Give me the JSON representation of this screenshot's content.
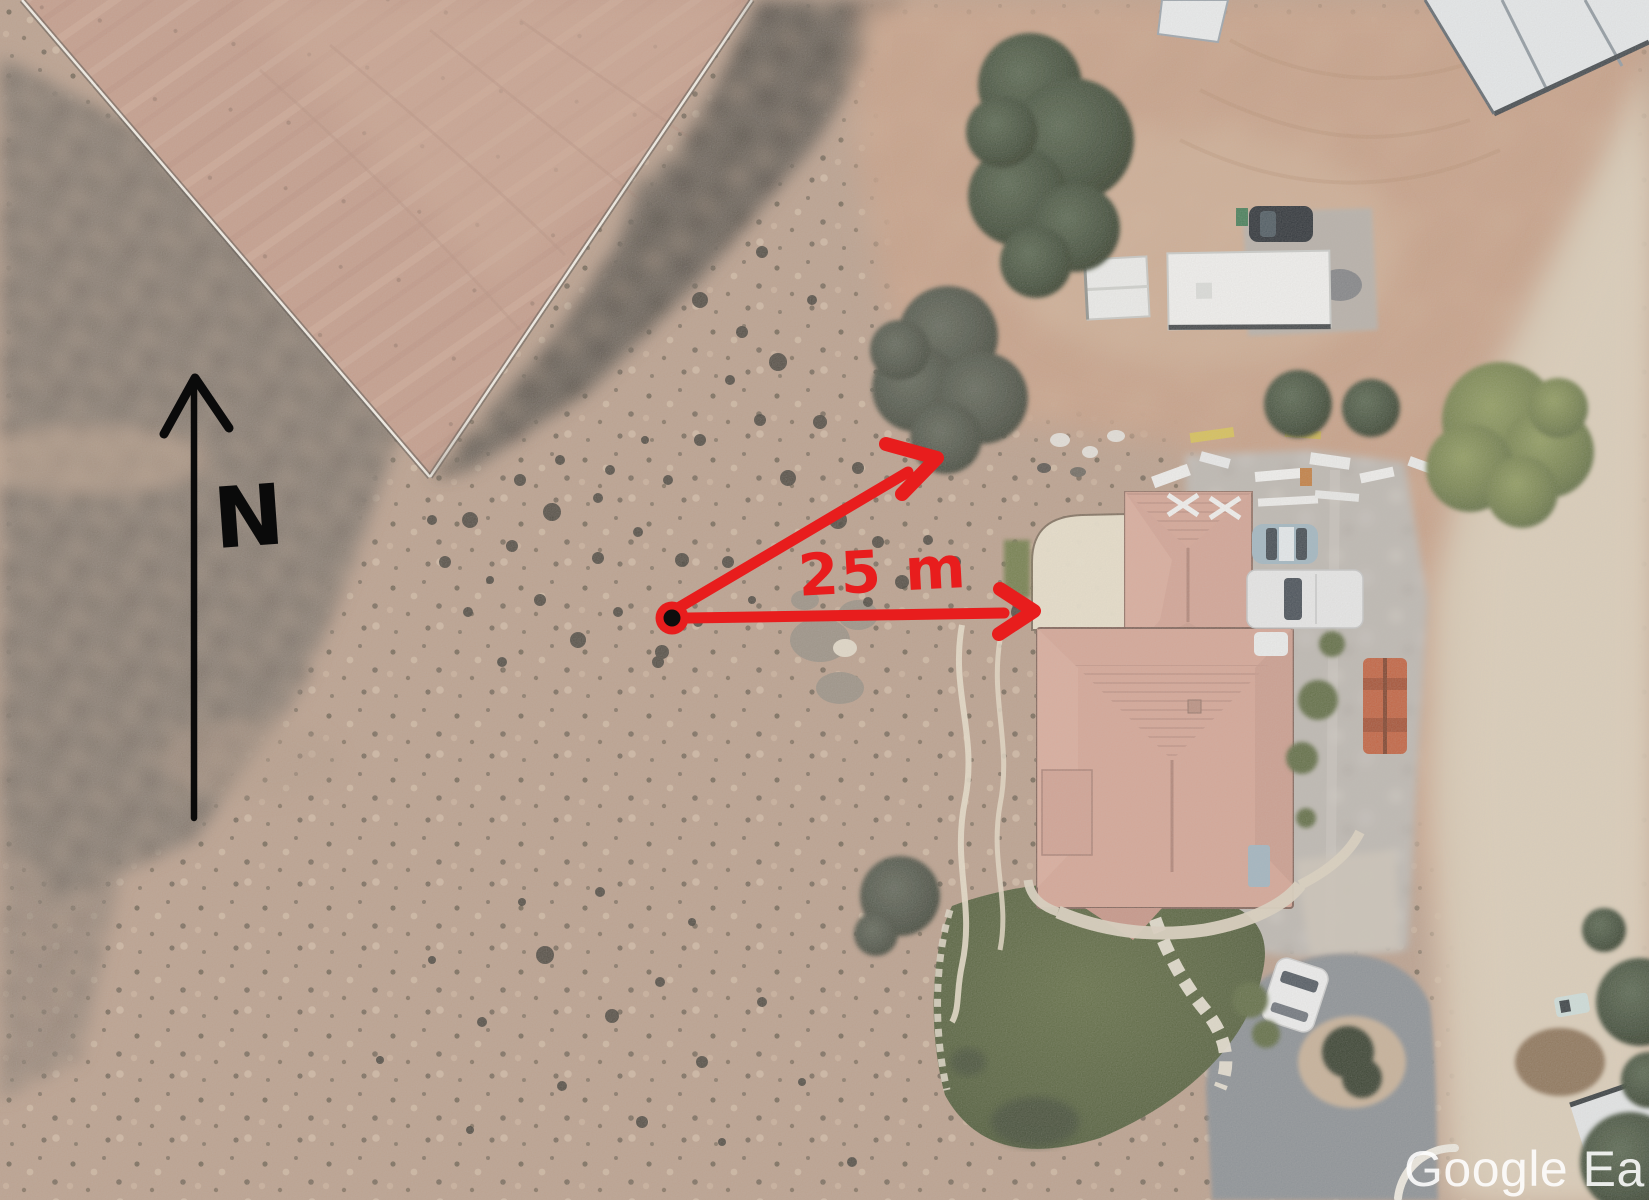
{
  "view": {
    "description": "Aerial satellite photo of a desert property with a house, outbuildings, a graded dirt field, annotated with a north arrow and a 25 m measurement arrow pair",
    "width_px": 1649,
    "height_px": 1200
  },
  "annotations": {
    "north": {
      "label": "N",
      "color": "#0a0a0a",
      "arrow": "vertical-arrow-pointing-up"
    },
    "measurement": {
      "label": "25 m",
      "color": "#e81d1d",
      "origin_marker": "red-dot-with-black-center",
      "arrow_east": "horizontal-arrow-pointing-right",
      "arrow_northeast": "diagonal-arrow-pointing-at-tree"
    }
  },
  "watermark": {
    "text": "Google Ea",
    "color": "#ffffff"
  },
  "scene": {
    "type": "satellite-aerial-photo",
    "palette": {
      "desert_tan": "#bb9f8b",
      "scrub_gray": "#877a6e",
      "dirt_field_pink": "#c59b88",
      "dark_brush": "#3e3b33",
      "house_roof_terracotta": "#d6a493",
      "lawn_green": "#4d5a35",
      "asphalt_gray": "#888e93",
      "concrete_gray": "#bdb8b1",
      "dirt_road_light": "#d9c9b2",
      "tree_dark_green": "#2c3626",
      "tree_olive": "#6e7c46",
      "annotation_red": "#e81d1d",
      "annotation_black": "#0a0a0a",
      "fence_white": "#f7f3ea"
    },
    "features": [
      "graded-dirt-field",
      "white-fence-lines",
      "desert-scrub",
      "dark-brush-wash",
      "main-house-terracotta-roof",
      "sport-court-pad",
      "lawn-with-stone-path",
      "concrete-driveway",
      "asphalt-driveway-loop",
      "dirt-road",
      "white-trailer",
      "shed",
      "metal-barn-roof",
      "small-roof",
      "bottom-right-building",
      "dark-suv",
      "blue-sedan",
      "white-pickup",
      "white-car",
      "orange-forklift",
      "construction-materials",
      "trees",
      "rock-landscaping"
    ]
  }
}
